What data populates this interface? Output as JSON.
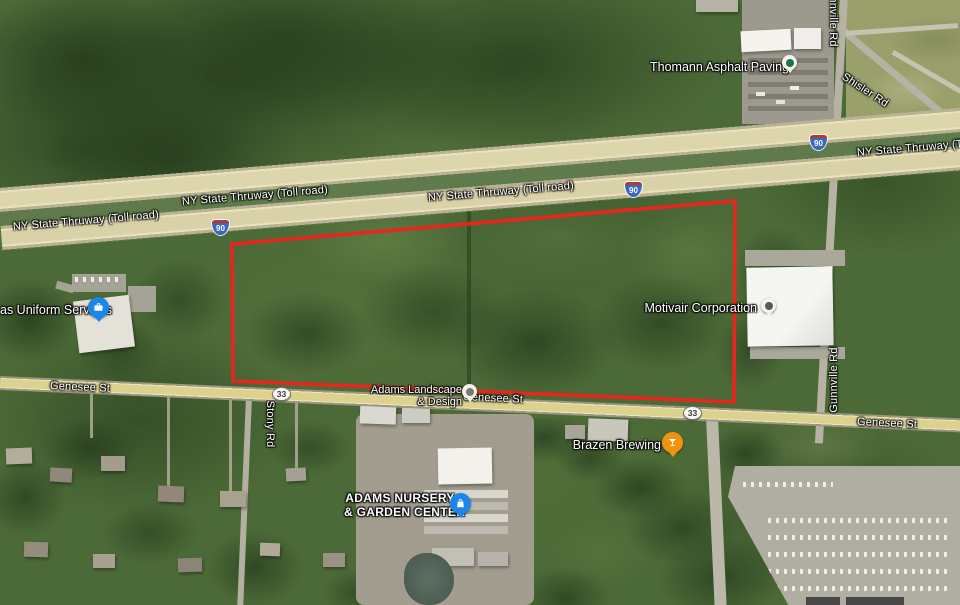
{
  "roads": {
    "thruway_label": "NY State Thruway (Toll road)",
    "genesee_label": "Genesee St",
    "shisler_label": "Shisler Rd",
    "gunnville_label": "Gunnville Rd",
    "stony_label": "Stony Rd",
    "interstate_shield": "90",
    "route_shield": "33"
  },
  "places": {
    "thomann": "Thomann Asphalt Paving",
    "uniform": "as Uniform Services",
    "motivair": "Motivair Corporation",
    "adams_landscape_line1": "Adams Landscape",
    "adams_landscape_line2": "& Design",
    "brazen": "Brazen Brewing",
    "nursery_line1": "ADAMS NURSERY",
    "nursery_line2": "& GARDEN CENTER"
  },
  "overlay": {
    "parcel_points": "232,244 735,201 734,402 233,381",
    "parcel_color": "#e8251f"
  },
  "pin_colors": {
    "thomann": "#15745a",
    "motivair": "#4e5e56",
    "adams_landscape": "#787878",
    "uniform": "#1a86e8",
    "nursery": "#1a86e8",
    "brazen": "#f0940c"
  }
}
